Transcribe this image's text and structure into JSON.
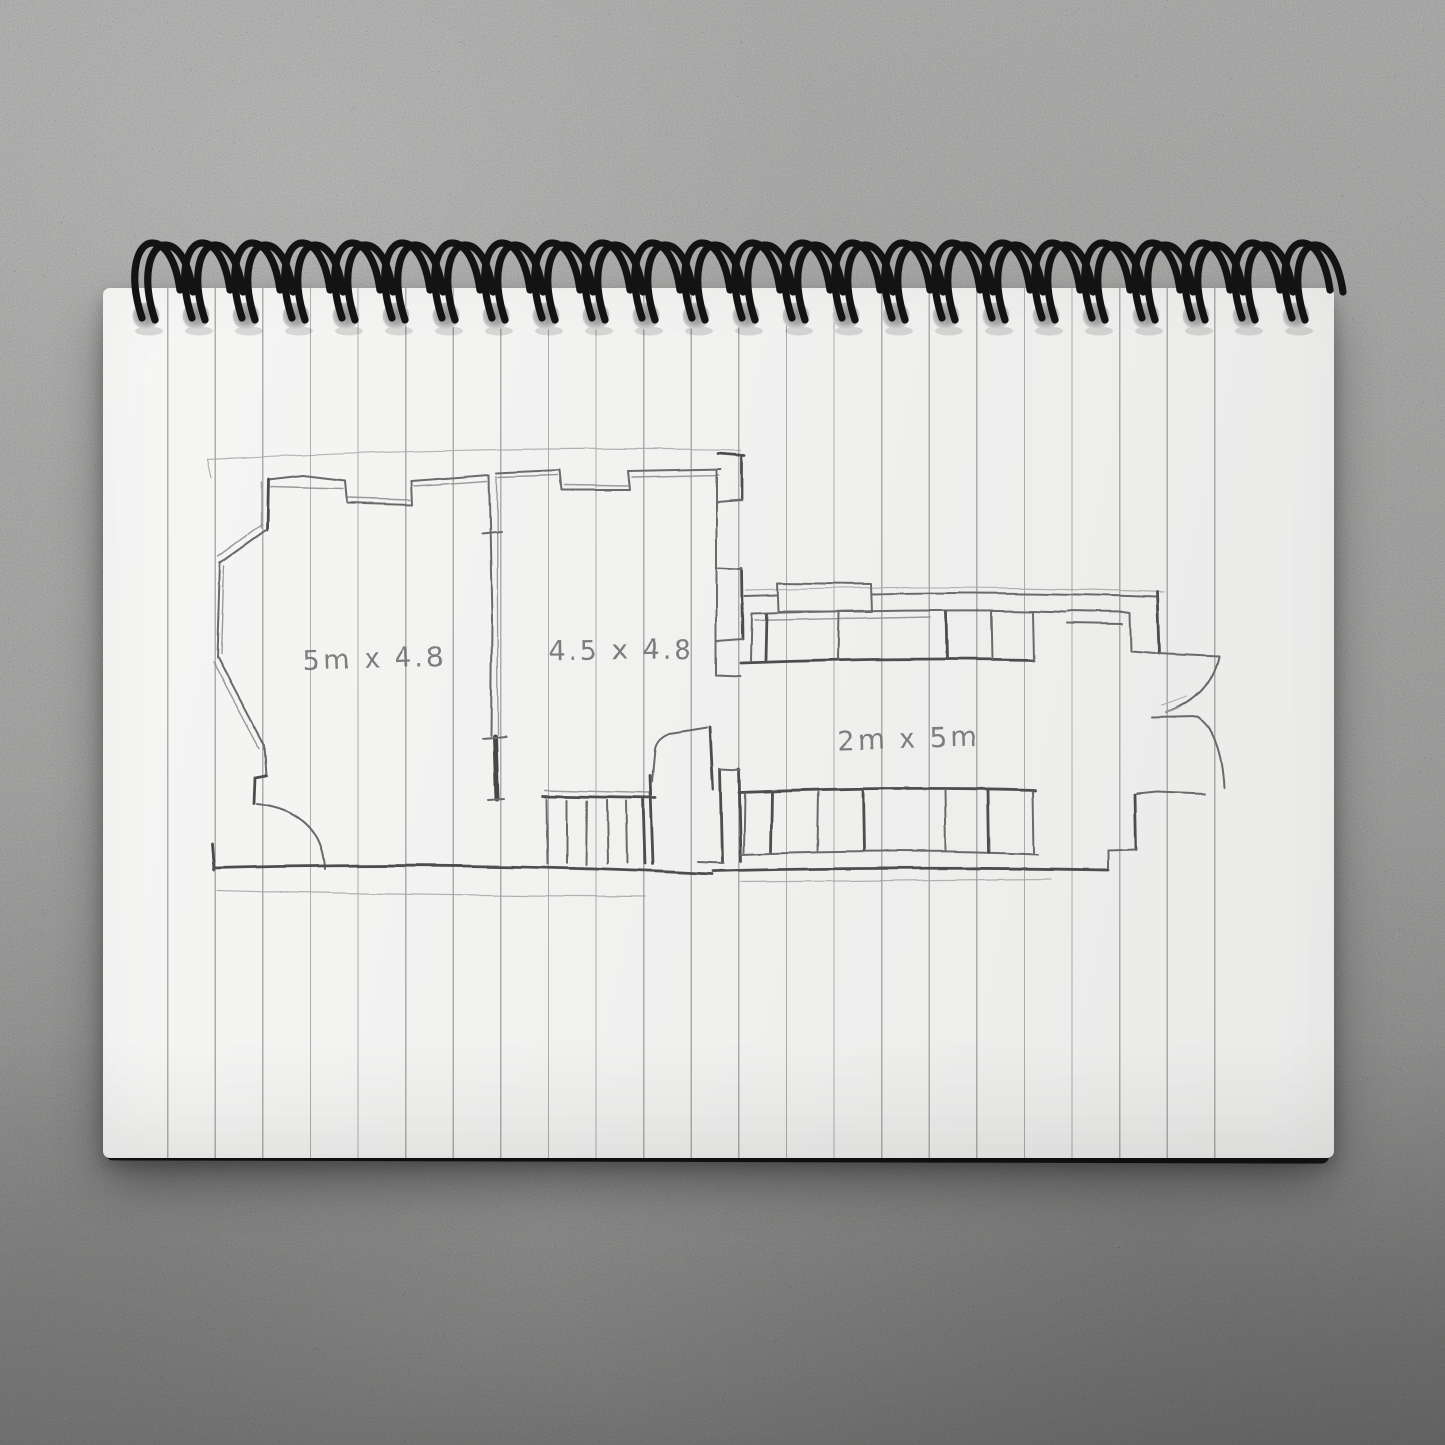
{
  "notebook": {
    "binding": {
      "style": "double-loop-wire",
      "coil_count": 24,
      "wire_color": "#131313"
    },
    "page": {
      "paper_color": "#f2f2f1",
      "ruled_line_color": "#8f8f8f",
      "ruled_line_count": 23,
      "orientation": "landscape"
    },
    "surface": {
      "material": "concrete",
      "base_color": "#a9a9a9"
    }
  },
  "floor_plan": {
    "pencil_color": "#6b6b6b",
    "labels": {
      "room_left": "5m x 4.8",
      "room_middle": "4.5 x 4.8",
      "room_right": "2m x 5m"
    },
    "features": [
      "angled-bay-left-wall",
      "door-arc-bottom-left",
      "interior-divider-wall",
      "stairs-bottom-center",
      "chimney-breast-wall",
      "cabinet-row-top",
      "cabinet-row-bottom",
      "double-door-arcs-right-end"
    ]
  }
}
